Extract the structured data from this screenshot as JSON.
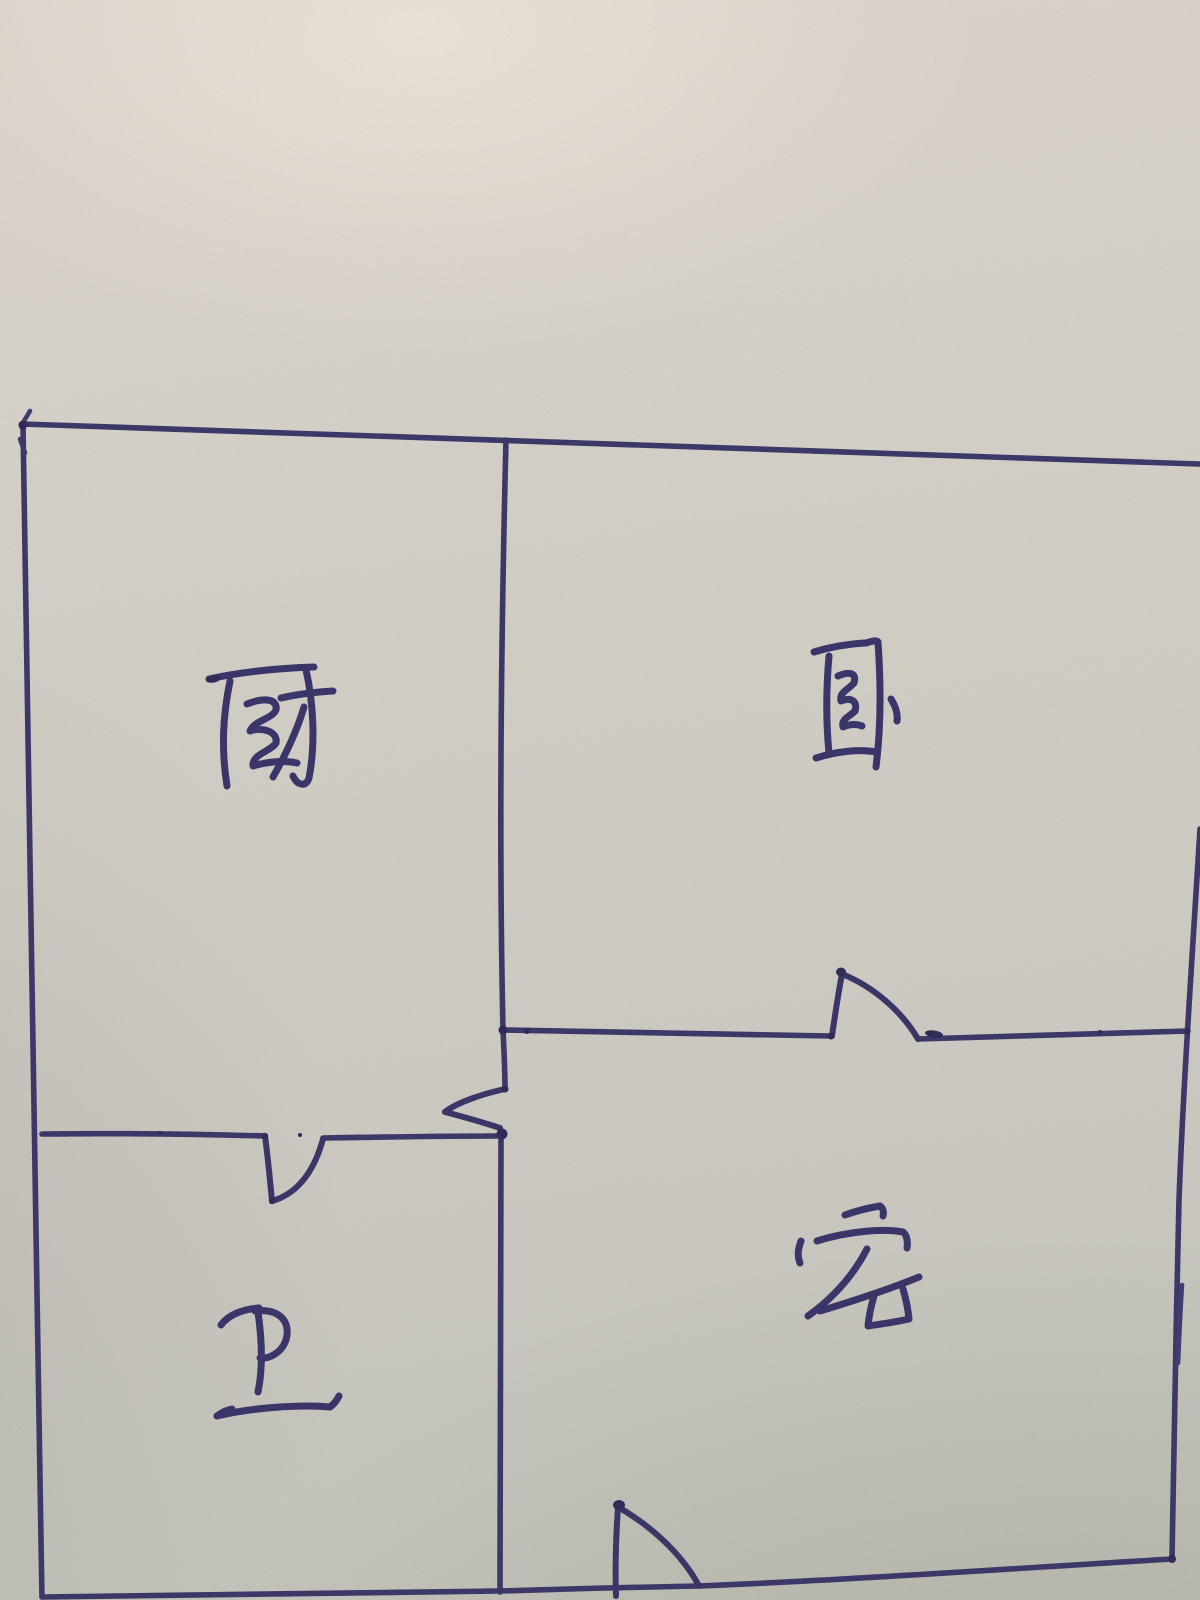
{
  "scene": {
    "description": "Hand-drawn apartment floor plan sketched in blue ballpoint pen on textured gray paper",
    "paper_color": "#d2cec6",
    "ink_color": "#3c3969"
  },
  "floor_plan": {
    "rooms": [
      {
        "id": "kitchen",
        "label": "厨",
        "meaning": "kitchen",
        "position": "top-left"
      },
      {
        "id": "bedroom",
        "label": "卧",
        "meaning": "bedroom",
        "position": "top-right"
      },
      {
        "id": "bathroom",
        "label": "卫",
        "meaning": "bathroom",
        "position": "bottom-left"
      },
      {
        "id": "living-room",
        "label": "客",
        "meaning": "living room",
        "position": "bottom-right"
      }
    ],
    "doors": [
      {
        "id": "bedroom-door",
        "location": "wall between bedroom and living room",
        "swing": "into bedroom"
      },
      {
        "id": "kitchen-door",
        "location": "central wall between kitchen and living room",
        "swing": "into kitchen"
      },
      {
        "id": "bathroom-door",
        "location": "wall between kitchen and bathroom",
        "swing": "into bathroom"
      },
      {
        "id": "entry-door",
        "location": "bottom wall of living room",
        "swing": "into living room"
      }
    ]
  }
}
